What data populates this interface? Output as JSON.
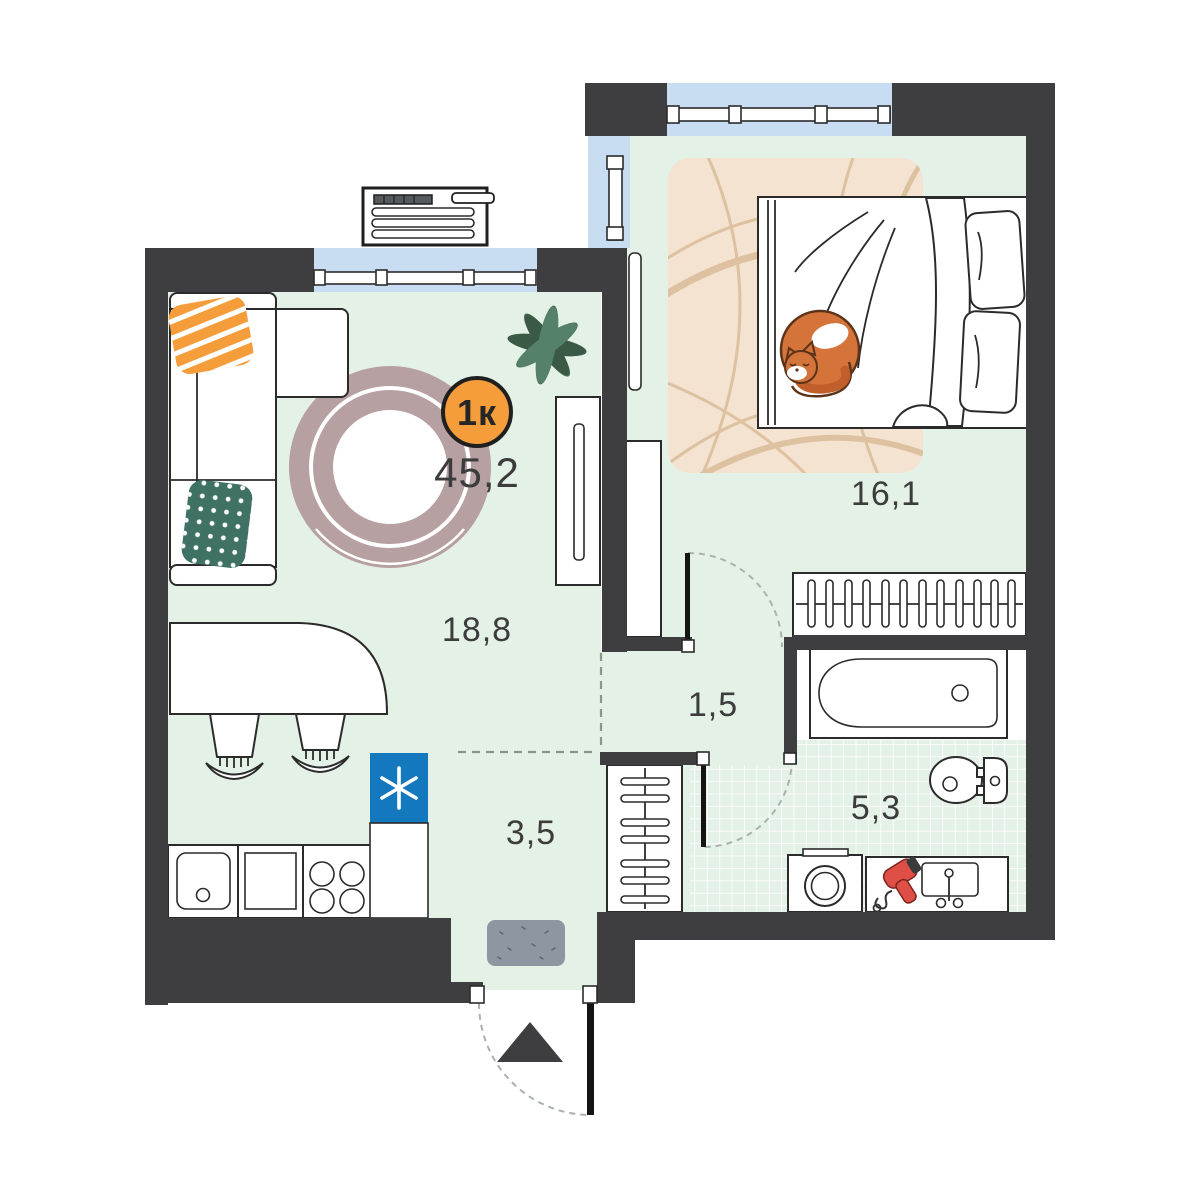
{
  "plan": {
    "badge": {
      "label": "1к"
    },
    "total_area": "45,2",
    "rooms": [
      {
        "name": "living-room",
        "area": "18,8"
      },
      {
        "name": "bedroom",
        "area": "16,1"
      },
      {
        "name": "hall",
        "area": "1,5"
      },
      {
        "name": "entry",
        "area": "3,5"
      },
      {
        "name": "bathroom",
        "area": "5,3"
      }
    ],
    "furniture": [
      "corner-sofa",
      "round-rug",
      "dining-table",
      "two-stools",
      "kitchen-sink",
      "counter",
      "stove",
      "fridge-freezer",
      "tall-cabinet",
      "wardrobe",
      "hanger-closet-bedroom",
      "hanger-closet-hall",
      "bed",
      "cat",
      "bedroom-rug",
      "plant",
      "ac-unit",
      "bathtub",
      "toilet",
      "washing-machine",
      "hairdryer",
      "bathroom-sink",
      "doormat",
      "entrance-arrow"
    ],
    "colors": {
      "wall": "#3e3e40",
      "floor": "#e4f1e6",
      "window": "#c8ddf2",
      "badge": "#f59d3b",
      "fridge": "#1478be",
      "rug_beige": "#f4e3d0",
      "rug_arc": "#d8b995",
      "round_rug": "#b7a0a2",
      "doormat": "#8d97a1",
      "pillow_orange": "#f59d3b",
      "pillow_teal": "#3f7265",
      "cat": "#d4743b",
      "hairdryer": "#df4f45",
      "plant": "#47684f",
      "pot": "#83402f",
      "door_leaf": "#141414"
    }
  }
}
